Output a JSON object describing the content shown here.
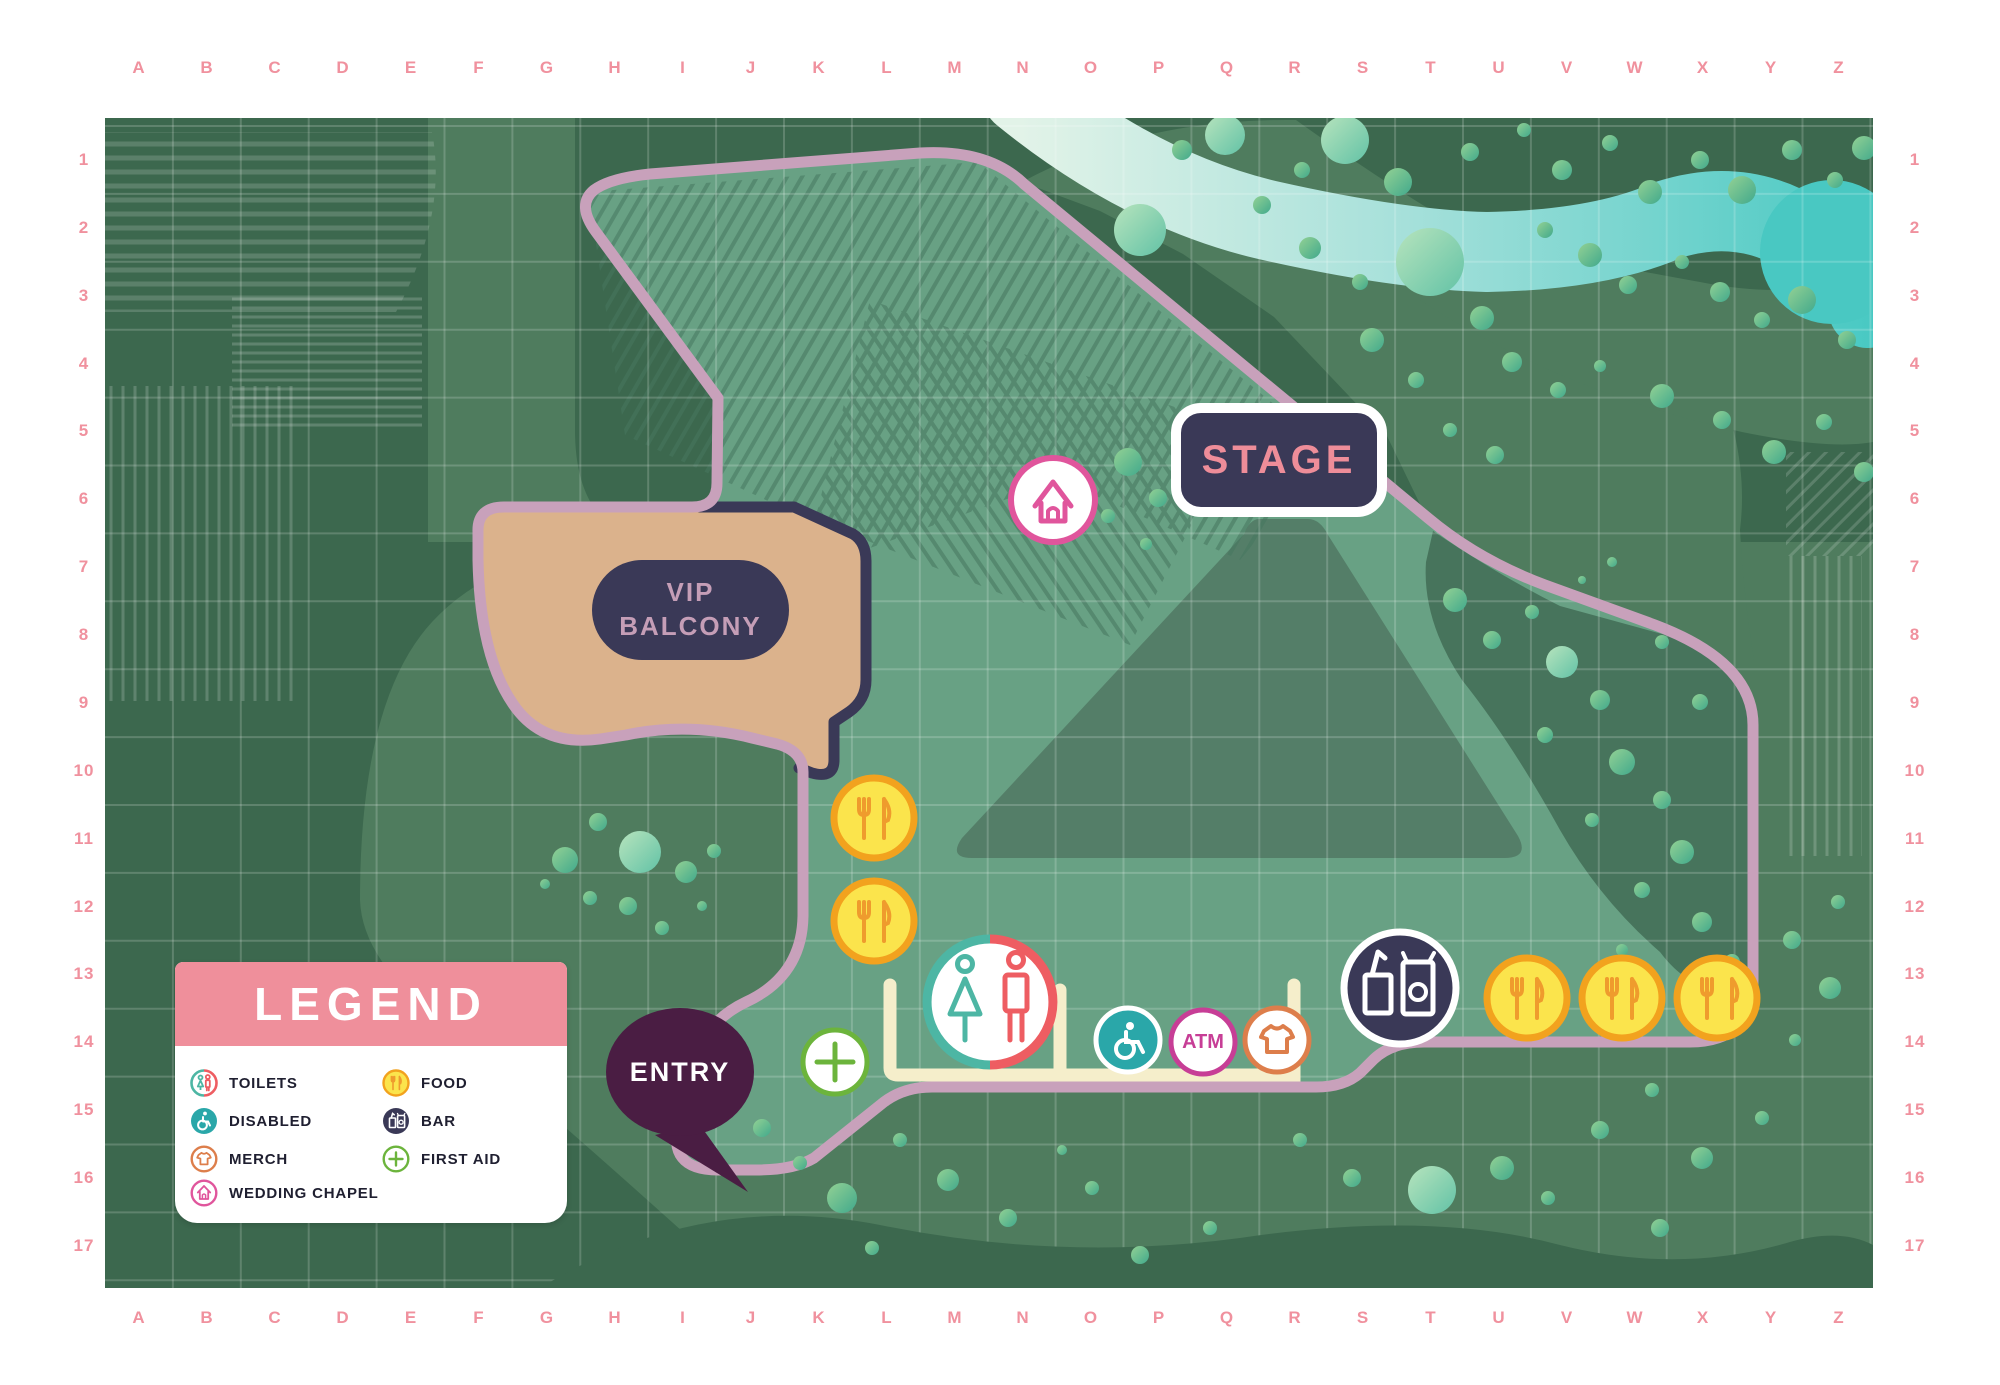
{
  "grid": {
    "columns": [
      "A",
      "B",
      "C",
      "D",
      "E",
      "F",
      "G",
      "H",
      "I",
      "J",
      "K",
      "L",
      "M",
      "N",
      "O",
      "P",
      "Q",
      "R",
      "S",
      "T",
      "U",
      "V",
      "W",
      "X",
      "Y",
      "Z"
    ],
    "rows": [
      "1",
      "2",
      "3",
      "4",
      "5",
      "6",
      "7",
      "8",
      "9",
      "10",
      "11",
      "12",
      "13",
      "14",
      "15",
      "16",
      "17"
    ]
  },
  "map": {
    "stage_label": "STAGE",
    "vip_label_line1": "VIP",
    "vip_label_line2": "BALCONY",
    "entry_label": "ENTRY",
    "atm_label": "ATM"
  },
  "legend": {
    "title": "LEGEND",
    "items": [
      {
        "icon": "toilets-icon",
        "label": "TOILETS"
      },
      {
        "icon": "disabled-icon",
        "label": "DISABLED"
      },
      {
        "icon": "merch-icon",
        "label": "MERCH"
      },
      {
        "icon": "wedding-chapel-icon",
        "label": "WEDDING CHAPEL"
      },
      {
        "icon": "food-icon",
        "label": "FOOD"
      },
      {
        "icon": "bar-icon",
        "label": "BAR"
      },
      {
        "icon": "first-aid-icon",
        "label": "FIRST AID"
      }
    ]
  },
  "colors": {
    "accent_pink": "#f0919e",
    "boundary_pink": "#c8a1bb",
    "navy": "#3a3957",
    "festival_green": "#68a184",
    "dark_green": "#3c684e",
    "medium_green": "#4f7c5e",
    "cone_green": "#547e68",
    "vip_tan": "#dbb28c",
    "fence_cream": "#f5eecb",
    "river_teal": "#49c8c2",
    "entry_plum": "#4a1d43",
    "toilet_teal": "#4db6a4",
    "toilet_coral": "#ee5d62",
    "disabled_teal": "#2aa7a9",
    "atm_magenta": "#c73e96",
    "merch_orange": "#dd7e4b",
    "food_yellow": "#fbe44c",
    "food_orange": "#f2a21e",
    "first_aid_green": "#6cb43c",
    "chapel_pink": "#e0559c"
  }
}
